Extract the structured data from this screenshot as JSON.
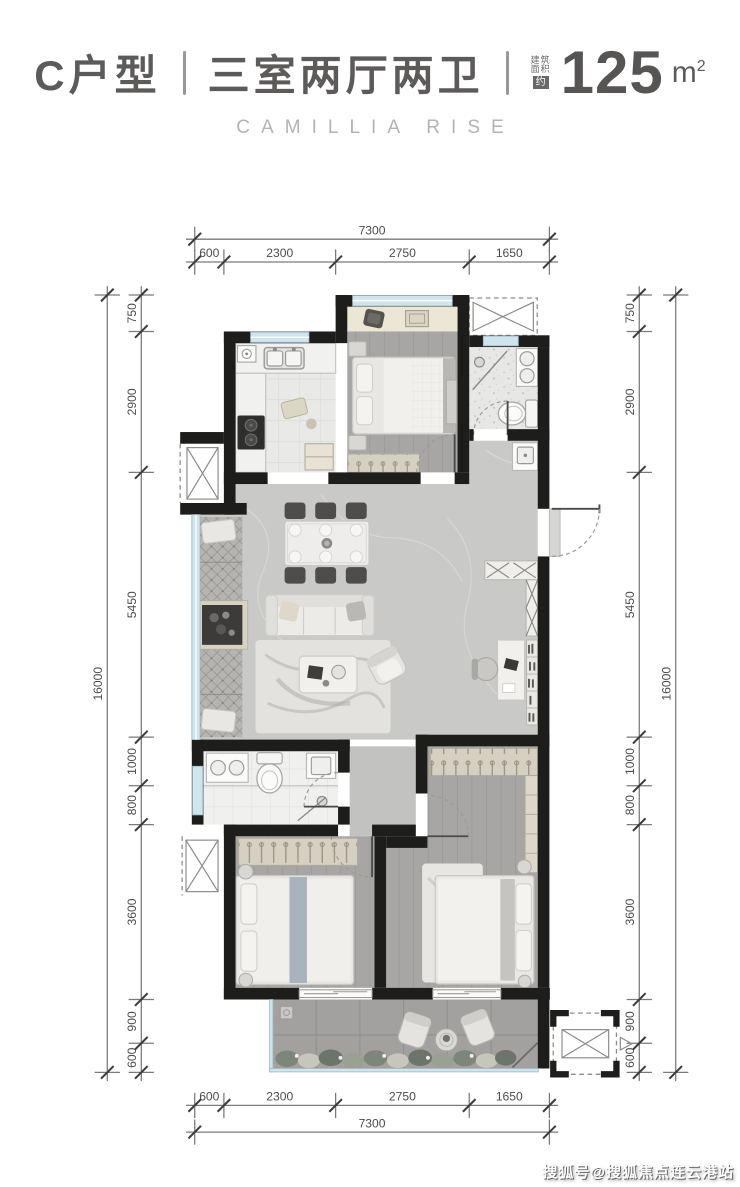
{
  "header": {
    "unit_label": "C户型",
    "layout_label": "三室两厅两卫",
    "area_prefix_top": "建筑",
    "area_prefix_bottom": "面积",
    "area_badge": "约",
    "area_value": "125",
    "area_unit_letter": "m",
    "area_unit_sup": "2",
    "subtitle": "CAMILLIA RISE"
  },
  "dimensions": {
    "top": {
      "total": "7300",
      "segments": [
        "600",
        "2300",
        "2750",
        "1650"
      ]
    },
    "bottom": {
      "total": "7300",
      "segments": [
        "600",
        "2300",
        "2750",
        "1650"
      ]
    },
    "left": {
      "total": "16000",
      "segments": [
        "750",
        "2900",
        "5450",
        "1000",
        "800",
        "3600",
        "900",
        "600"
      ]
    },
    "right": {
      "total": "16000",
      "segments": [
        "750",
        "2900",
        "5450",
        "1000",
        "800",
        "3600",
        "900",
        "600"
      ]
    }
  },
  "watermark": "搜狐号@搜狐焦点连云港站",
  "colors": {
    "wall": "#1d1d1b",
    "dim_text": "#4c4c4c",
    "title_text": "#5d5a5a",
    "subtitle_text": "#b4b2b2",
    "window_glass": "#cfe4ec",
    "wood_floor": "#a7a6a4",
    "marble_floor": "#c9c9c7"
  }
}
